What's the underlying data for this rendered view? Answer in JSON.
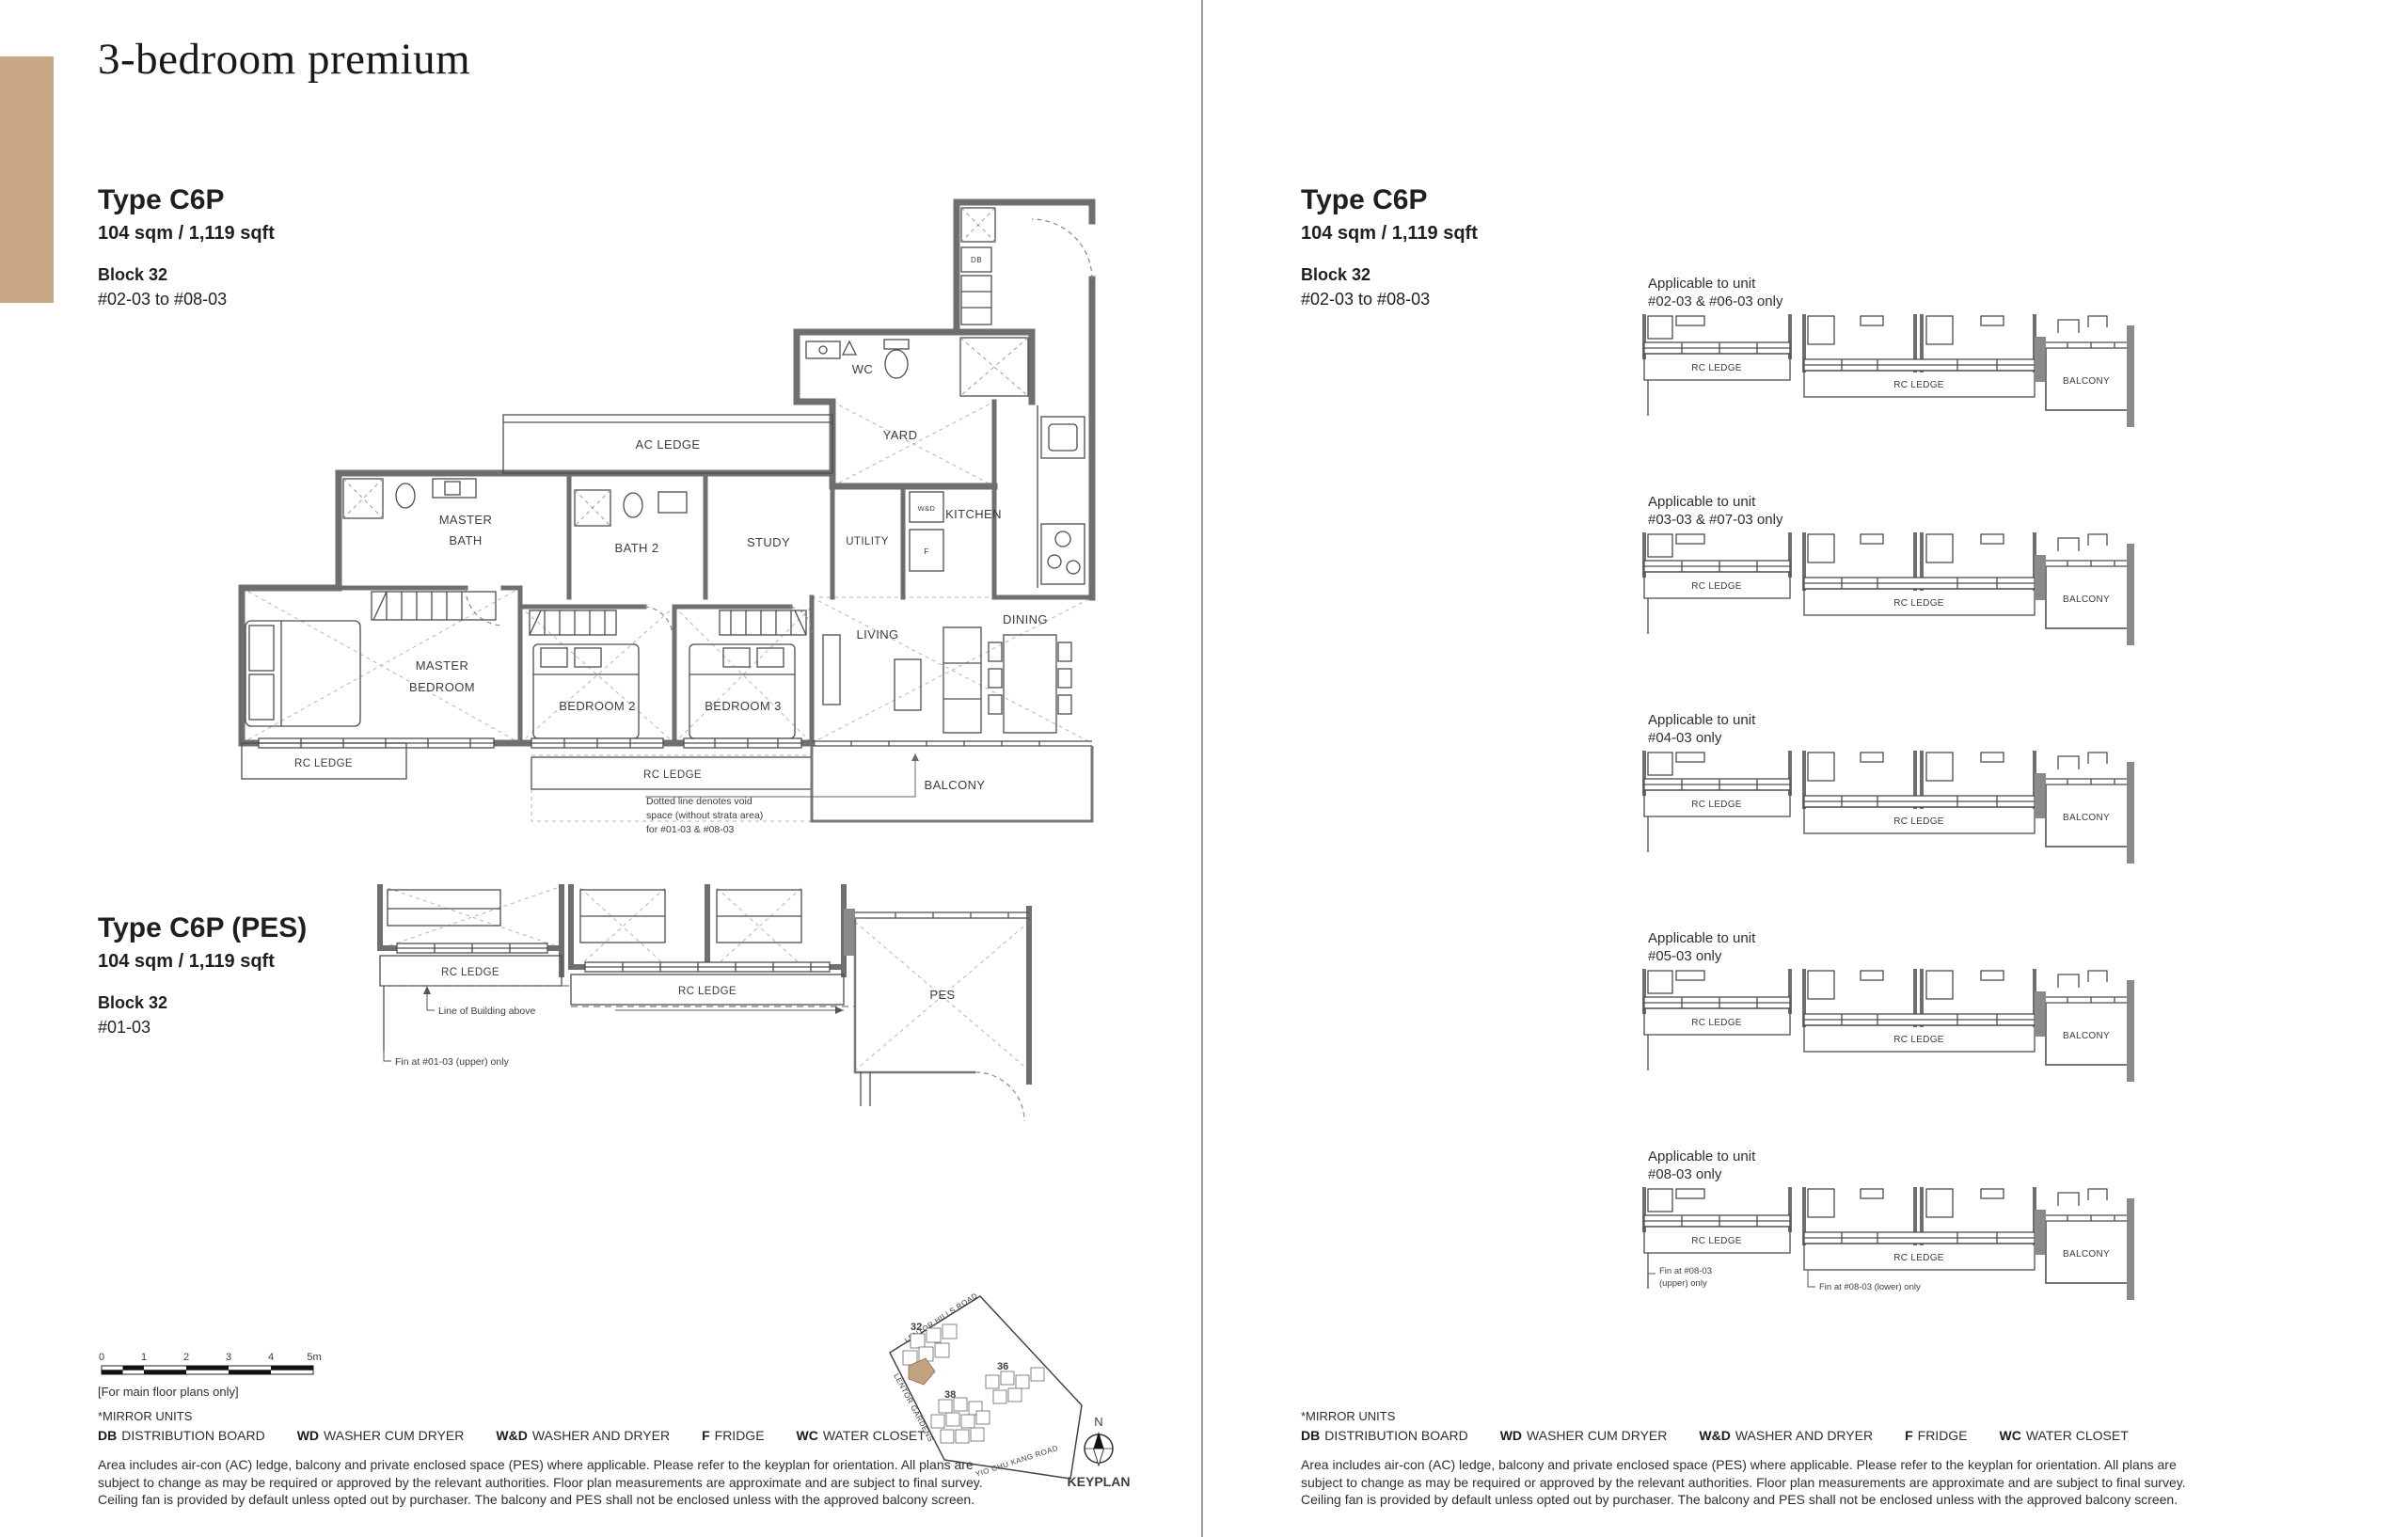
{
  "page": {
    "title": "3-bedroom premium"
  },
  "headers": {
    "main": {
      "type": "Type C6P",
      "area": "104 sqm / 1,119 sqft",
      "block": "Block 32",
      "units": "#02-03 to #08-03"
    },
    "pes": {
      "type": "Type C6P (PES)",
      "area": "104 sqm / 1,119 sqft",
      "block": "Block 32",
      "units": "#01-03"
    }
  },
  "rooms": {
    "wc": "WC",
    "yard": "YARD",
    "kitchen": "KITCHEN",
    "utility": "UTILITY",
    "study": "STUDY",
    "bath2": "BATH 2",
    "master_bath_1": "MASTER",
    "master_bath_2": "BATH",
    "ac_ledge": "AC LEDGE",
    "master_bed_1": "MASTER",
    "master_bed_2": "BEDROOM",
    "bedroom2": "BEDROOM 2",
    "bedroom3": "BEDROOM 3",
    "living": "LIVING",
    "dining": "DINING",
    "balcony": "BALCONY",
    "rc_ledge_left": "RC LEDGE",
    "rc_ledge_mid": "RC LEDGE",
    "db": "DB",
    "wd": "W&D",
    "fridge": "F",
    "pes": "PES",
    "pes_rc_left": "RC LEDGE",
    "pes_rc_mid": "RC LEDGE"
  },
  "notes": {
    "void_1": "Dotted line denotes void",
    "void_2": "space (without strata area)",
    "void_3": "for #01-03 & #08-03",
    "line_building": "Line of Building above",
    "fin_0103": "Fin at #01-03 (upper) only"
  },
  "variants": [
    {
      "line1": "Applicable to unit",
      "line2": "#02-03 & #06-03 only",
      "rc1": "RC LEDGE",
      "rc2": "RC LEDGE",
      "balcony": "BALCONY"
    },
    {
      "line1": "Applicable to unit",
      "line2": "#03-03 & #07-03 only",
      "rc1": "RC LEDGE",
      "rc2": "RC LEDGE",
      "balcony": "BALCONY"
    },
    {
      "line1": "Applicable to unit",
      "line2": "#04-03 only",
      "rc1": "RC LEDGE",
      "rc2": "RC LEDGE",
      "balcony": "BALCONY"
    },
    {
      "line1": "Applicable to unit",
      "line2": "#05-03 only",
      "rc1": "RC LEDGE",
      "rc2": "RC LEDGE",
      "balcony": "BALCONY"
    },
    {
      "line1": "Applicable to unit",
      "line2": "#08-03 only",
      "rc1": "RC LEDGE",
      "rc2": "RC LEDGE",
      "balcony": "BALCONY",
      "fin_u1": "Fin at #08-03",
      "fin_u2": "(upper) only",
      "fin_l": "Fin at #08-03 (lower) only"
    }
  ],
  "scalebar": {
    "t0": "0",
    "t1": "1",
    "t2": "2",
    "t3": "3",
    "t4": "4",
    "t5": "5m",
    "note": "[For main floor plans only]"
  },
  "legend": {
    "mirror": "*MIRROR UNITS",
    "items": [
      {
        "k": "DB",
        "v": "DISTRIBUTION BOARD"
      },
      {
        "k": "WD",
        "v": "WASHER CUM DRYER"
      },
      {
        "k": "W&D",
        "v": "WASHER AND DRYER"
      },
      {
        "k": "F",
        "v": "FRIDGE"
      },
      {
        "k": "WC",
        "v": "WATER CLOSET"
      }
    ],
    "disc_1": "Area includes air-con (AC) ledge, balcony and private enclosed space (PES) where applicable. Please refer to the keyplan for orientation. All plans are",
    "disc_2": "subject to change as may be required or approved by the relevant authorities. Floor plan measurements are approximate and are subject to final survey.",
    "disc_3": "Ceiling fan is provided by default unless opted out by purchaser. The balcony and PES shall not be enclosed unless with the approved balcony screen."
  },
  "keyplan": {
    "road_1": "LENTOR HILLS ROAD",
    "road_2": "LENTOR GARDENS",
    "road_3": "YIO CHU KANG ROAD",
    "b32": "32",
    "b36": "36",
    "b38": "38",
    "north": "N",
    "label": "KEYPLAN"
  },
  "colors": {
    "accent": "#c9a886",
    "wall": "#6f6f6f",
    "text": "#1f1f1f"
  }
}
